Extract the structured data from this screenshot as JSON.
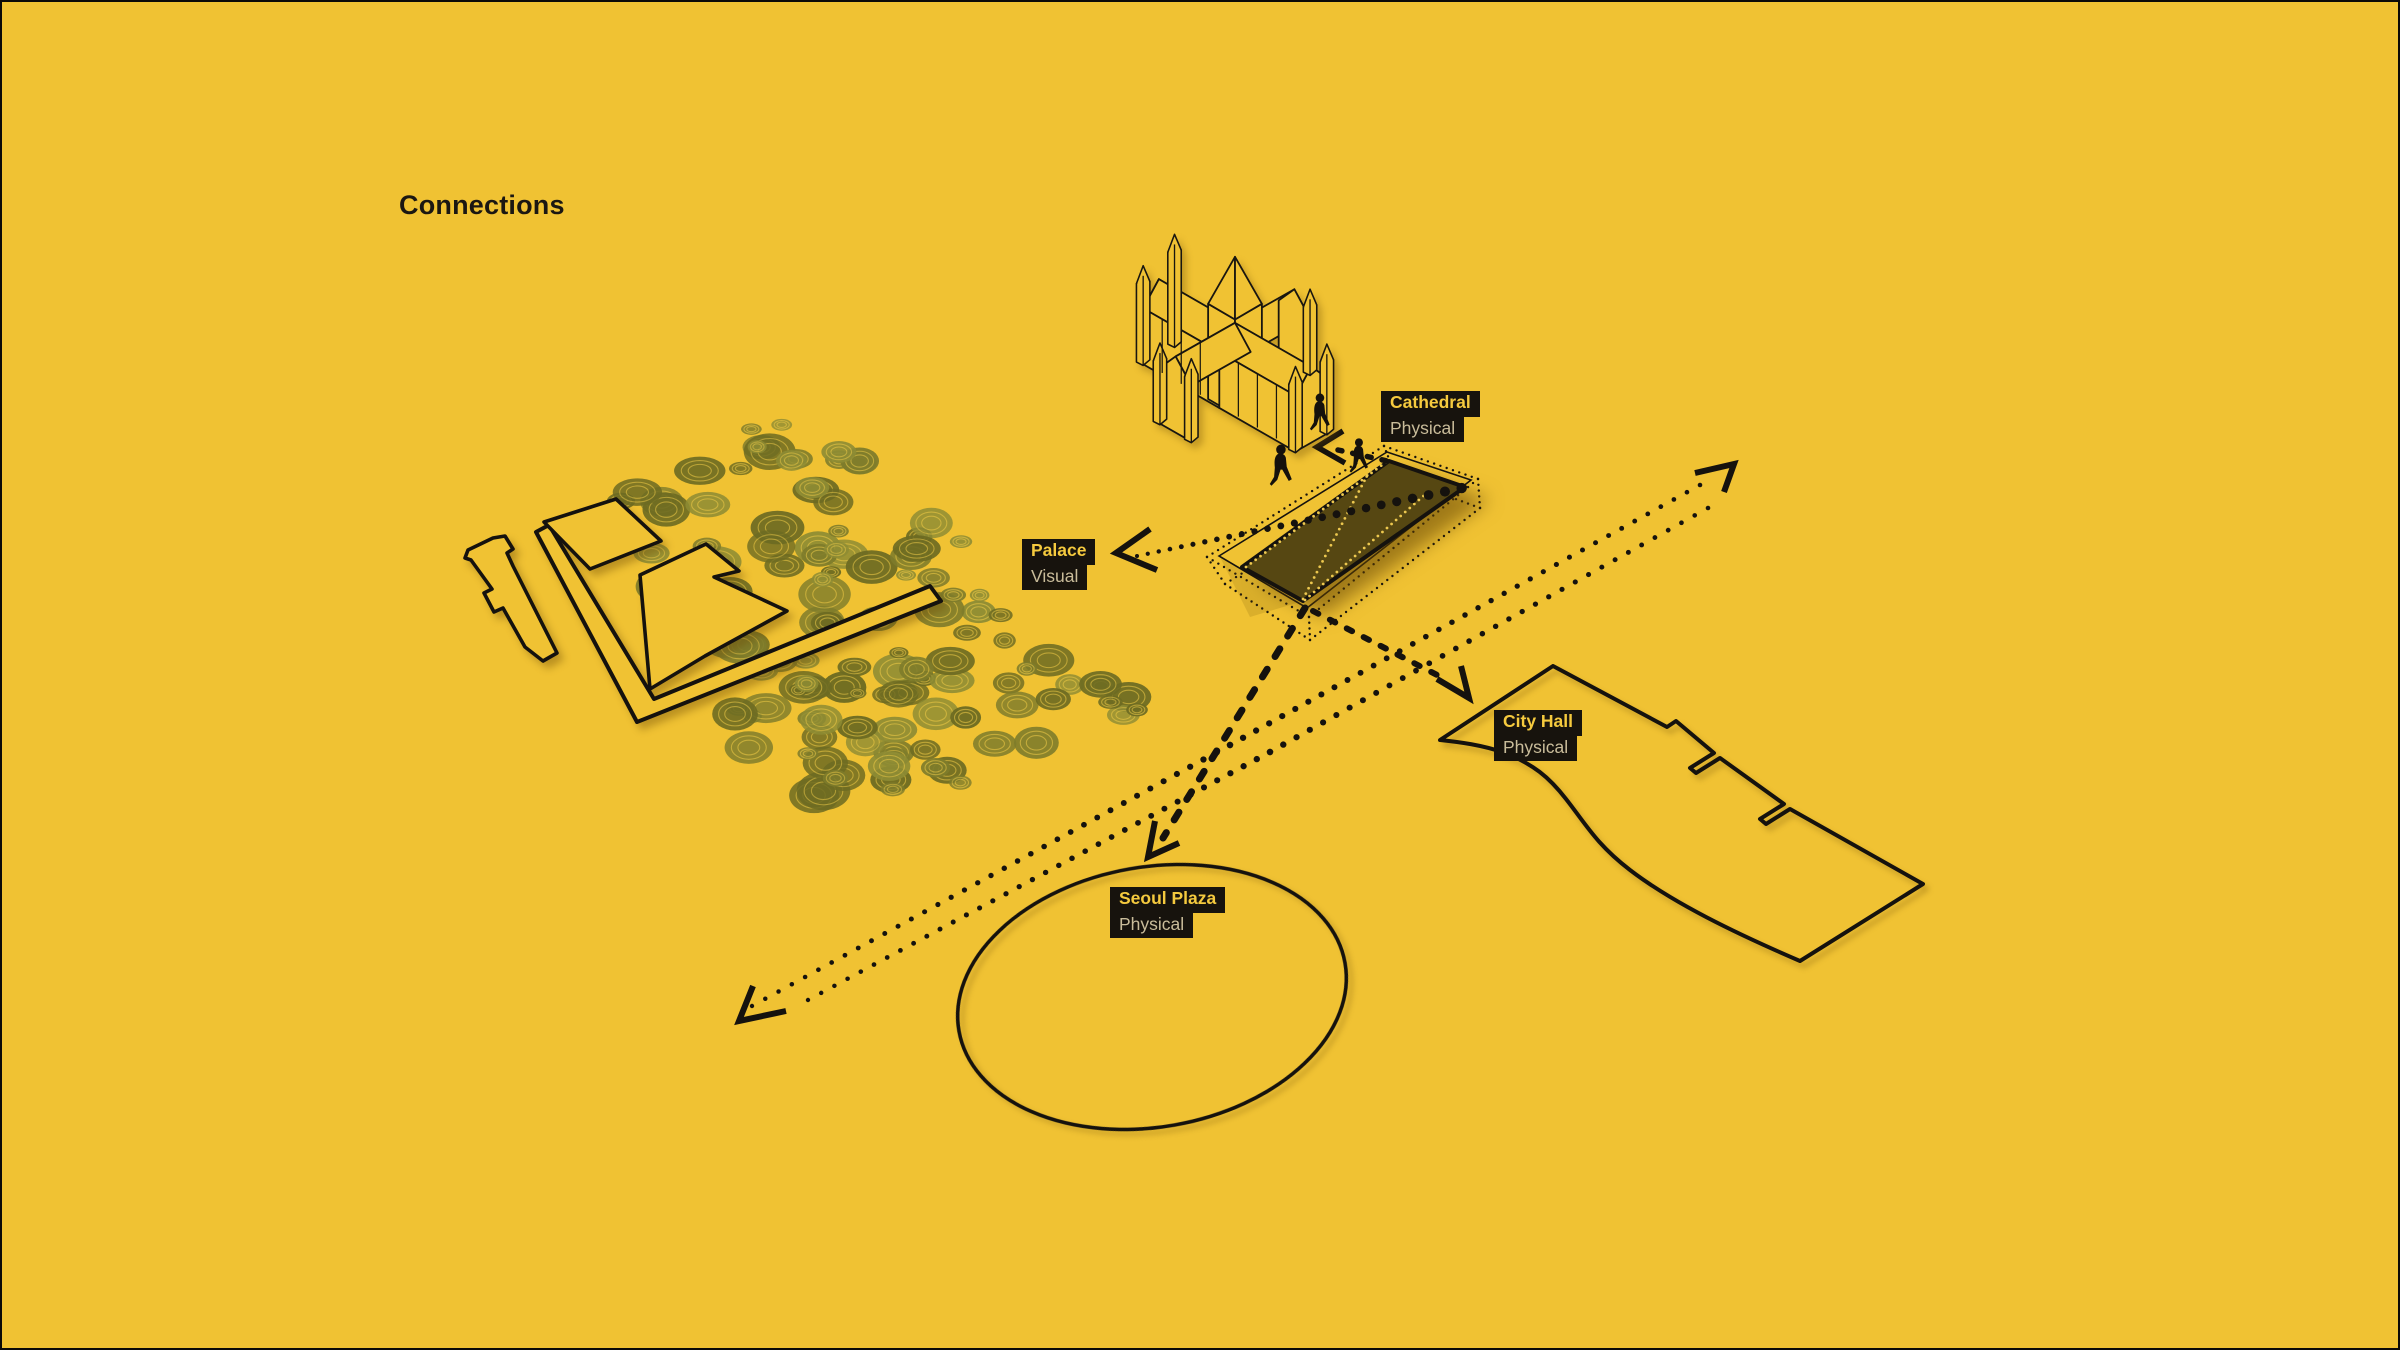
{
  "title": "Connections",
  "colors": {
    "background": "#F0C233",
    "site_fill": "#564712",
    "label_bg": "#17130D",
    "label_primary": "#F5CA3E",
    "label_secondary": "#C9BC9A",
    "line": "#15120E",
    "tree_light": "#8E8C34",
    "tree_mid": "#7E7C2B",
    "tree_dark": "#6D6B22"
  },
  "labels": {
    "cathedral": {
      "name": "Cathedral",
      "type": "Physical"
    },
    "palace": {
      "name": "Palace",
      "type": "Visual"
    },
    "city_hall": {
      "name": "City Hall",
      "type": "Physical"
    },
    "seoul_plaza": {
      "name": "Seoul Plaza",
      "type": "Physical"
    }
  }
}
